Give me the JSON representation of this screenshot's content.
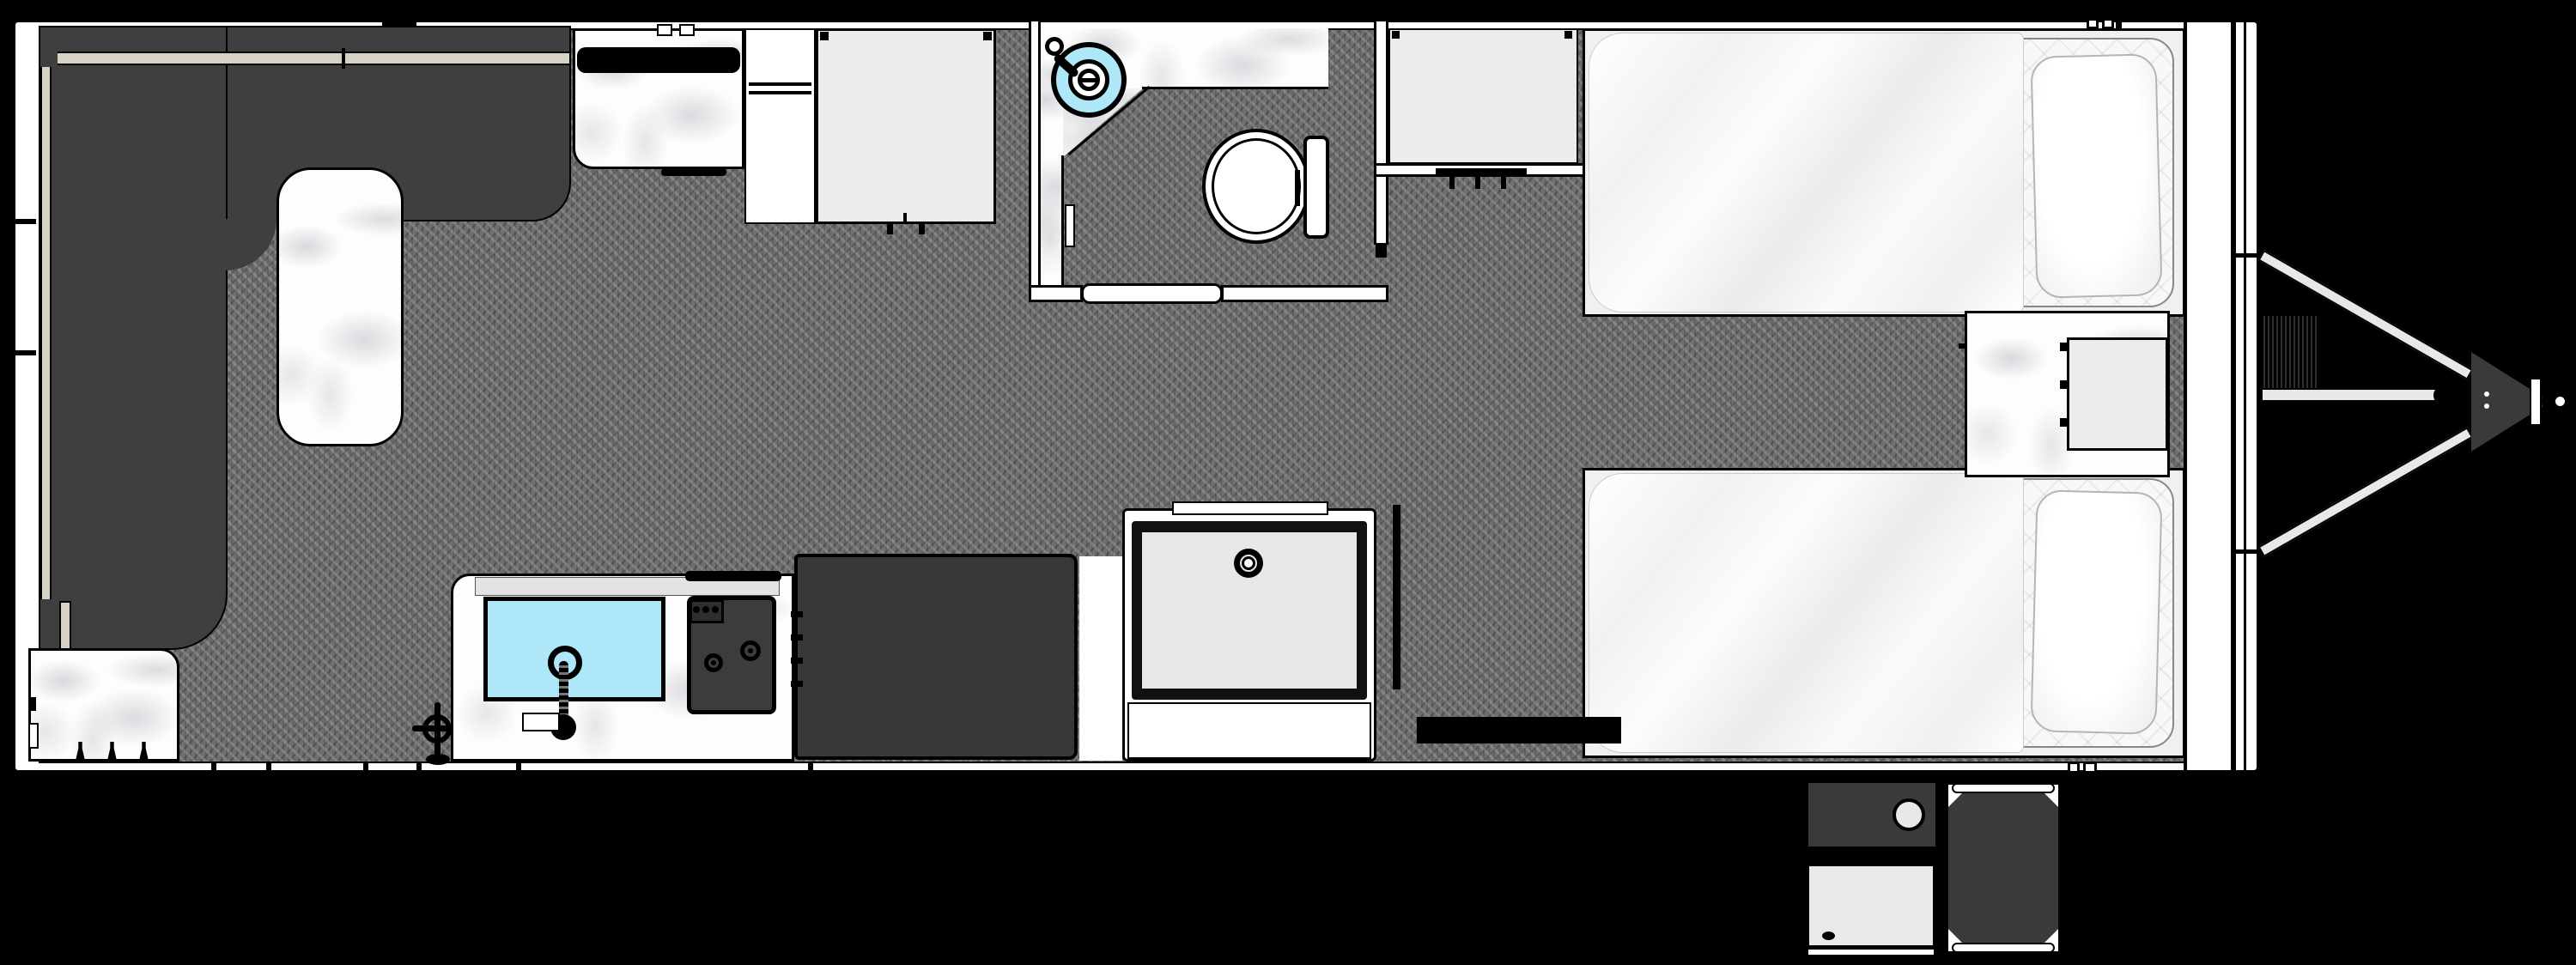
{
  "meta": {
    "diagram_type": "rv-travel-trailer-floorplan",
    "view": "top-down",
    "visible_text": []
  },
  "palette": {
    "background": "#000000",
    "walls": "#ffffff",
    "floor_carpet": "#6f6f6f",
    "sofa_dark": "#3f3f3f",
    "sofa_trim_beige": "#d6d2c4",
    "counter_marble": "#fdfdfd",
    "appliance_light": "#ececec",
    "cabinet_dark": "#383838",
    "water_cyan": "#aee8f8",
    "bedding_white": "#ffffff",
    "tongue_gray": "#e8e8e8"
  },
  "rooms": {
    "living_area": {
      "features": [
        "wrap-around-sofa",
        "marble-table"
      ]
    },
    "kitchen": {
      "features": [
        "corner-counter",
        "sink",
        "faucet",
        "cooktop",
        "oven-handle",
        "dark-cabinet",
        "upper-counter",
        "window-bar",
        "pantry",
        "refrigerator"
      ]
    },
    "bathroom": {
      "features": [
        "round-sink",
        "faucet",
        "vanity-counter",
        "toilet",
        "door",
        "towel-bar"
      ]
    },
    "wardrobe": {
      "features": [
        "hanger-rod"
      ]
    },
    "bedroom": {
      "features": [
        "bed-top",
        "bed-bottom",
        "pillows",
        "nightstand",
        "inset-cabinet",
        "foot-wall"
      ]
    }
  },
  "exterior": {
    "front": [
      "a-frame-tongue-bars",
      "tongue-jack",
      "coupler",
      "hitch-ball-socket",
      "propane-area"
    ],
    "door_side": [
      "entry-door-upper",
      "entry-door-lower",
      "entry-steps"
    ]
  },
  "icons": [
    "sink-drain-icon",
    "faucet-icon",
    "burner-icon",
    "knob-icon",
    "valve-icon",
    "hanger-rod-icon",
    "hinge-icon",
    "drain-ring-icon",
    "hitch-ball-icon"
  ]
}
